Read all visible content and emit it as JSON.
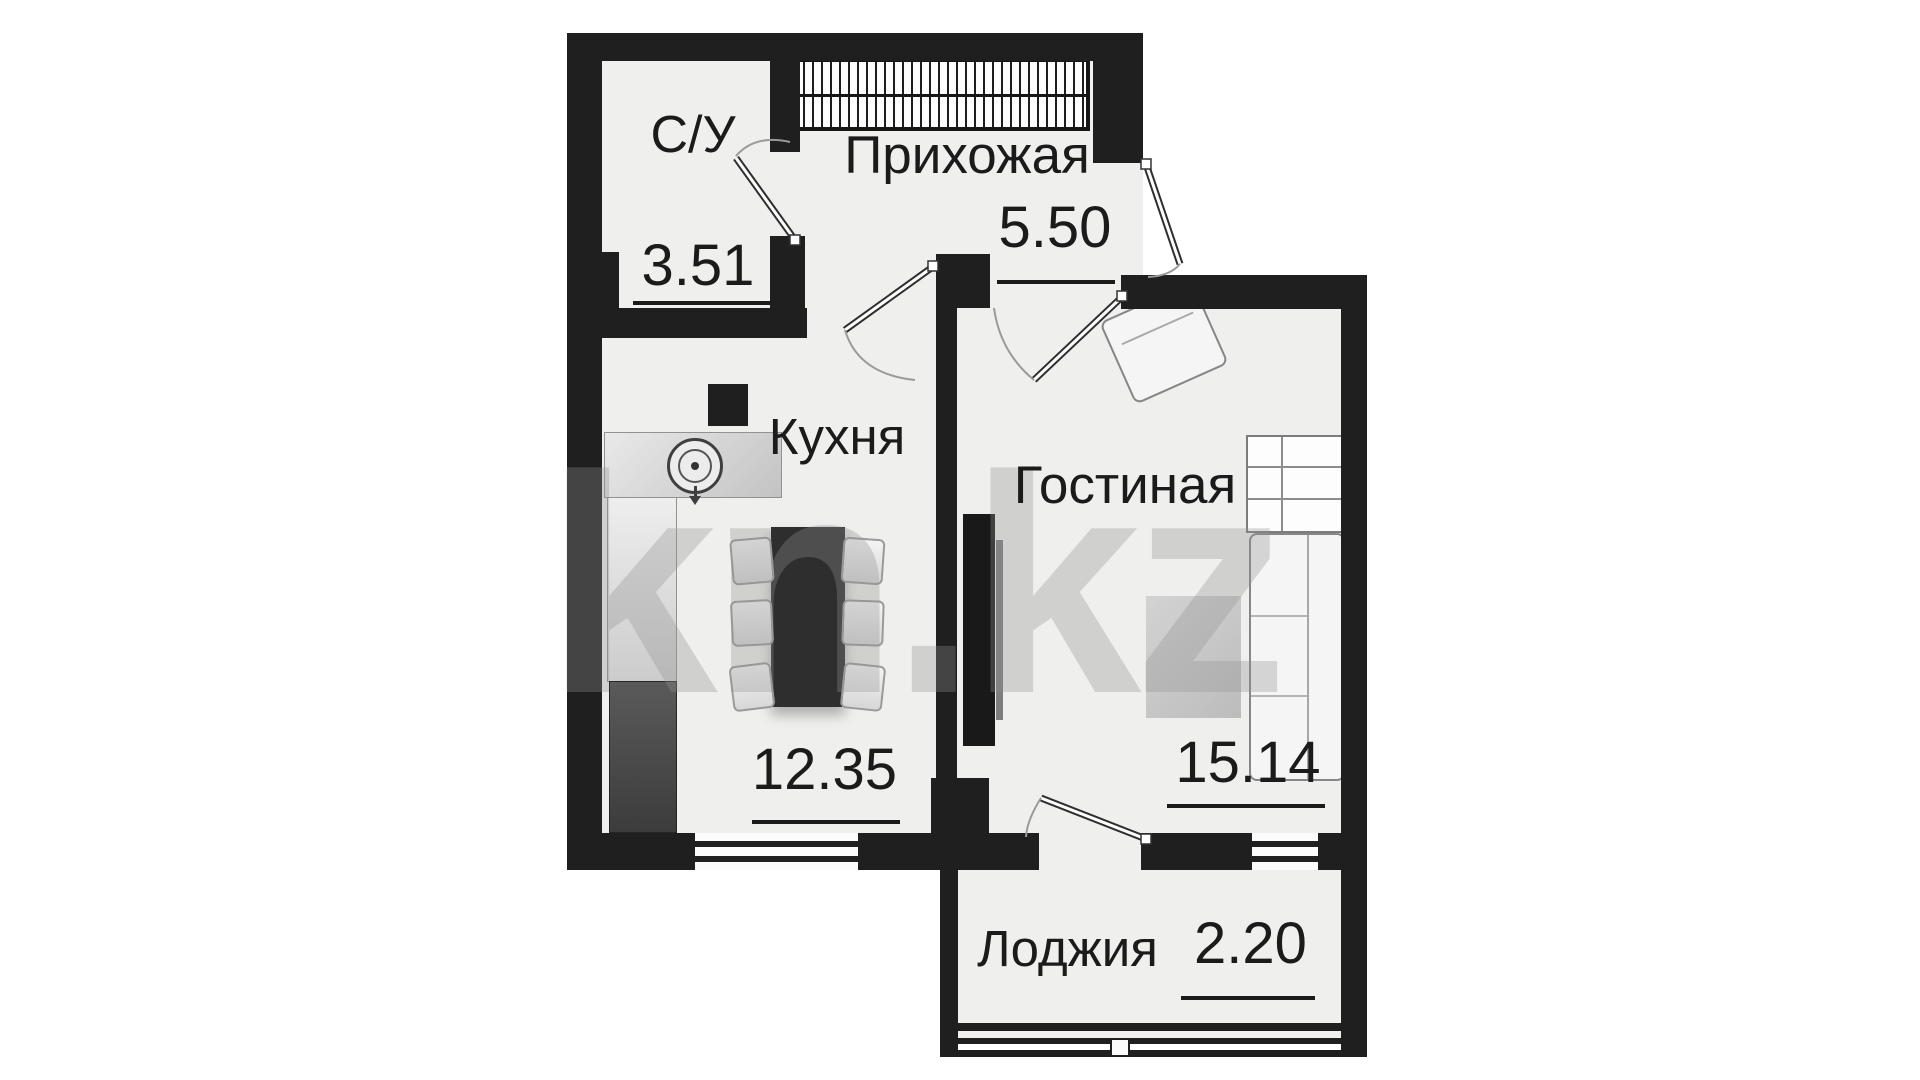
{
  "watermark": {
    "text": "kn.kz"
  },
  "rooms": [
    {
      "key": "bathroom",
      "name": "С/У",
      "area": "3.51"
    },
    {
      "key": "hallway",
      "name": "Прихожая",
      "area": "5.50"
    },
    {
      "key": "kitchen",
      "name": "Кухня",
      "area": "12.35"
    },
    {
      "key": "living-room",
      "name": "Гостиная",
      "area": "15.14"
    },
    {
      "key": "loggia",
      "name": "Лоджия",
      "area": "2.20"
    }
  ],
  "colors": {
    "wall": "#1f1f1f",
    "floor": "#efefee",
    "label": "#1b1b1b",
    "watermark_gray": "#919191",
    "furniture_dark": "#2e2e2e",
    "furniture_light": "#f5f5f5"
  }
}
